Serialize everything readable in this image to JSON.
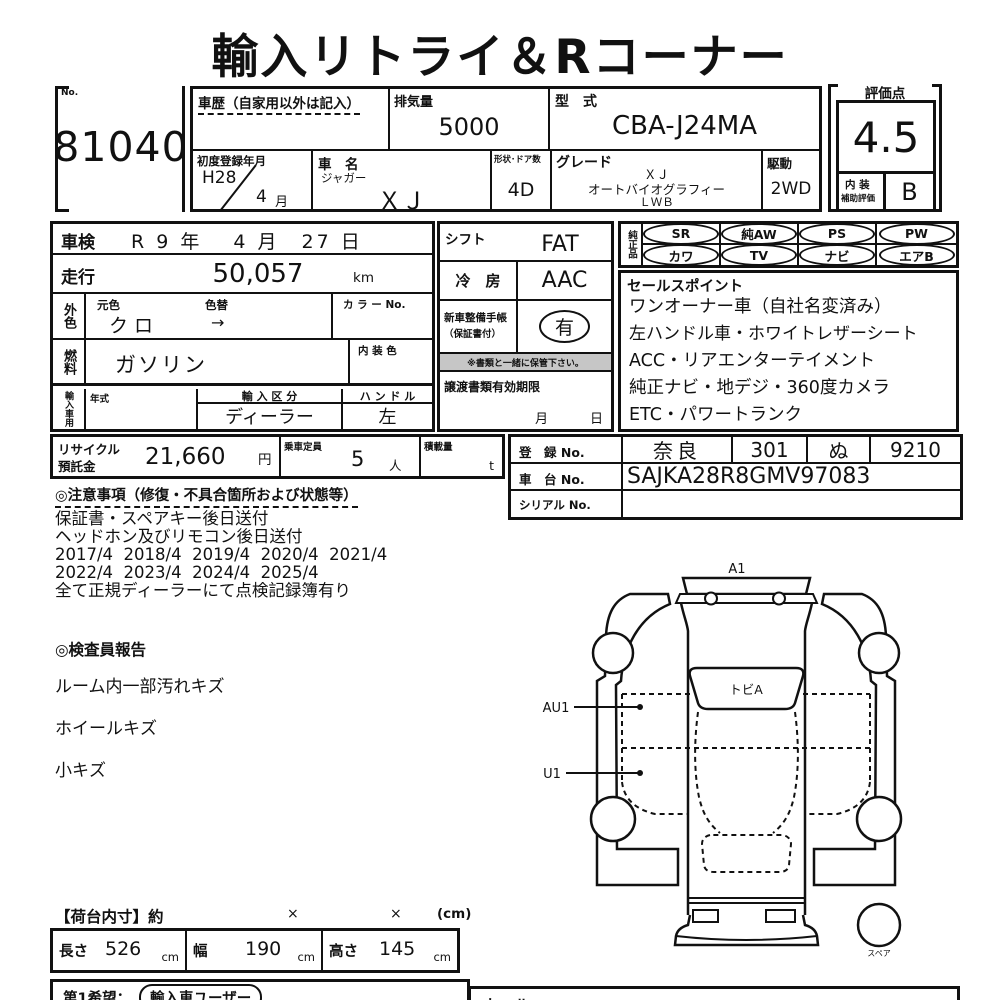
{
  "title": "輸入リトライ＆Rコーナー",
  "header": {
    "no_label": "No.",
    "lot_number": "81040",
    "history_label": "車歴（自家用以外は記入）",
    "displacement_label": "排気量",
    "displacement_value": "5000",
    "model_code_label": "型　式",
    "model_code_value": "CBA-J24MA",
    "first_reg_label": "初度登録年月",
    "first_reg_year": "H28",
    "first_reg_month_value": "4",
    "first_reg_month_unit": "月",
    "car_name_label": "車　名",
    "car_maker": "ジャガー",
    "car_model": "ＸＪ",
    "shape_doors_label": "形状･ドア数",
    "shape_doors_value": "4D",
    "grade_label": "グレード",
    "grade_lines": [
      "ＸＪ",
      "オートバイオグラフィー",
      "ＬＷＢ"
    ],
    "drive_label": "駆動",
    "drive_value": "2WD",
    "score_label": "評価点",
    "score_value": "4.5",
    "interior_label_1": "内 装",
    "interior_label_2": "補助評価",
    "interior_grade": "B"
  },
  "left": {
    "shaken_label": "車検",
    "shaken_value": "R 9 年　 4 月　27 日",
    "mileage_label": "走行",
    "mileage_value": "50,057",
    "mileage_unit": "km",
    "ext_color_label": "外色",
    "orig_color_label": "元色",
    "orig_color_value": "クロ",
    "color_change_label": "色替",
    "color_change_value": "→",
    "color_no_label": "カ ラ ー No.",
    "fuel_label": "燃料",
    "fuel_value": "ガソリン",
    "interior_color_label": "内 装 色",
    "import_section_label": "輸入車用",
    "year_label": "年式",
    "import_class_label": "輸 入 区 分",
    "import_class_value": "ディーラー",
    "handle_label": "ハ ン ド ル",
    "handle_value": "左"
  },
  "mid": {
    "shift_label": "シフト",
    "shift_value": "FAT",
    "ac_label": "冷　房",
    "ac_value": "AAC",
    "service_label_1": "新車整備手帳",
    "service_label_2": "（保証書付）",
    "service_value": "有",
    "service_note": "※書類と一緒に保管下さい。",
    "transfer_label": "譲渡書類有効期限",
    "transfer_month": "月",
    "transfer_day": "日"
  },
  "genuine": {
    "label": "純正品",
    "row1": [
      "SR",
      "純AW",
      "PS",
      "PW"
    ],
    "row2": [
      "カワ",
      "TV",
      "ナビ",
      "エアB"
    ]
  },
  "sales": {
    "title": "セールスポイント",
    "lines": [
      "ワンオーナー車（自社名変済み）",
      "左ハンドル車・ホワイトレザーシート",
      "ACC・リアエンターテイメント",
      "純正ナビ・地デジ・360度カメラ",
      "ETC・パワートランク"
    ]
  },
  "recycle": {
    "label_1": "リサイクル",
    "label_2": "預託金",
    "value": "21,660",
    "unit": "円",
    "capacity_label": "乗車定員",
    "capacity_value": "5",
    "capacity_unit": "人",
    "load_label": "積載量",
    "load_unit": "t"
  },
  "registration": {
    "reg_label": "登　録 No.",
    "reg_area": "奈良",
    "reg_class": "301",
    "reg_kana": "ぬ",
    "reg_number": "9210",
    "chassis_label": "車　台 No.",
    "chassis_value": "SAJKA28R8GMV97083",
    "serial_label": "シリアル No."
  },
  "notes": {
    "title": "◎注意事項（修復・不具合箇所および状態等）",
    "lines": [
      "保証書・スペアキー後日送付",
      "ヘッドホン及びリモコン後日送付",
      "2017/4  2018/4  2019/4  2020/4  2021/4",
      "2022/4  2023/4  2024/4  2025/4",
      "全て正規ディーラーにて点検記録簿有り"
    ]
  },
  "inspector": {
    "title": "◎検査員報告",
    "lines": [
      "ルーム内一部汚れキズ",
      "ホイールキズ",
      "小キズ"
    ]
  },
  "diagram": {
    "front_label": "A1",
    "windshield_label": "トビA",
    "left_front_label": "AU1",
    "left_rear_label": "U1",
    "spare_label": "スペア"
  },
  "cargo": {
    "title": "【荷台内寸】約",
    "times_1": "×",
    "times_2": "×",
    "unit_note": "(cm)",
    "length_label": "長さ",
    "length_value": "526",
    "length_unit": "cm",
    "width_label": "幅",
    "width_value": "190",
    "width_unit": "cm",
    "height_label": "高さ",
    "height_value": "145",
    "height_unit": "cm"
  },
  "footer": {
    "wish_label": "第1希望：",
    "wish_value": "輸入車ユーザー",
    "right_partial": "セール"
  }
}
